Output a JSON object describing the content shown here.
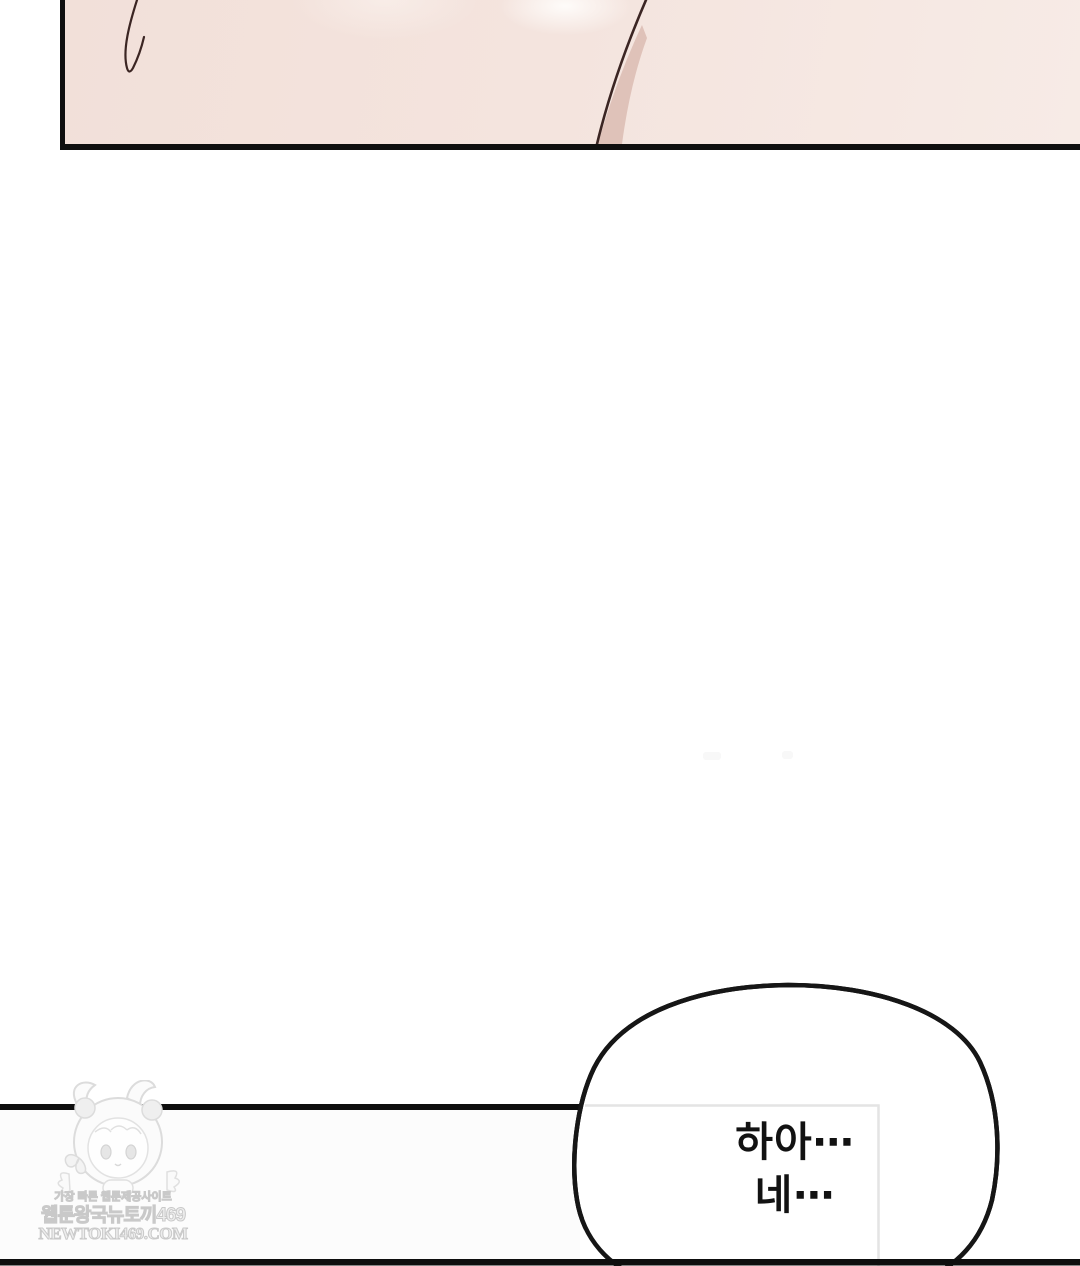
{
  "speech_bubble": {
    "line1": "하아⋯",
    "line2": "네⋯"
  },
  "watermark": {
    "tagline": "가장 빠른 웹툰제공사이트",
    "site_name": "웹툰왕국뉴토끼469",
    "site_url": "NEWTOKI469.COM",
    "mascot_icon": "chibi-girl-panda-hood-mascot"
  },
  "colors": {
    "page_background": "#ffffff",
    "panel_skin": "#f3e1da",
    "panel_skin_light": "#f7ebe6",
    "panel_border": "#0f0f0f",
    "hair_line": "#3b2523",
    "hair_shadow": "#c9a094",
    "bubble_stroke": "#161616",
    "dialogue_text": "#121212",
    "text_box_border": "#e4e4e4",
    "watermark_gray": "#d9d9d9"
  }
}
